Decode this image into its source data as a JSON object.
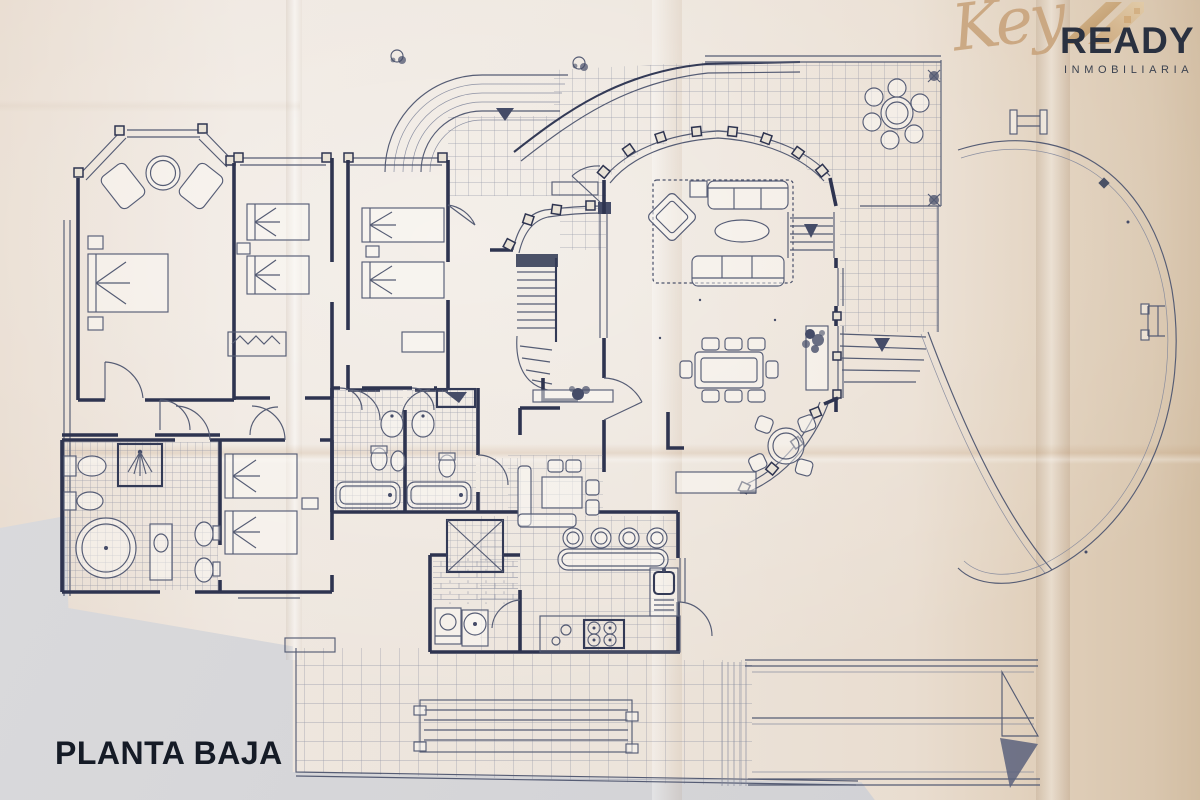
{
  "overlay": {
    "floor_label": "PLANTA BAJA"
  },
  "logo": {
    "script": "Key",
    "brand": "READY",
    "subtitle": "INMOBILIARIA"
  },
  "palette": {
    "paper": "#ece4db",
    "paper_warm": "#d9c6ae",
    "background_gray": "#d6d6d9",
    "ink_wall": "#2e3450",
    "ink_furniture": "#565d76",
    "ink_grid": "#81869b",
    "logo_gold": "#c9a57e",
    "logo_dark": "#2a3140",
    "label_text": "#151b26"
  }
}
